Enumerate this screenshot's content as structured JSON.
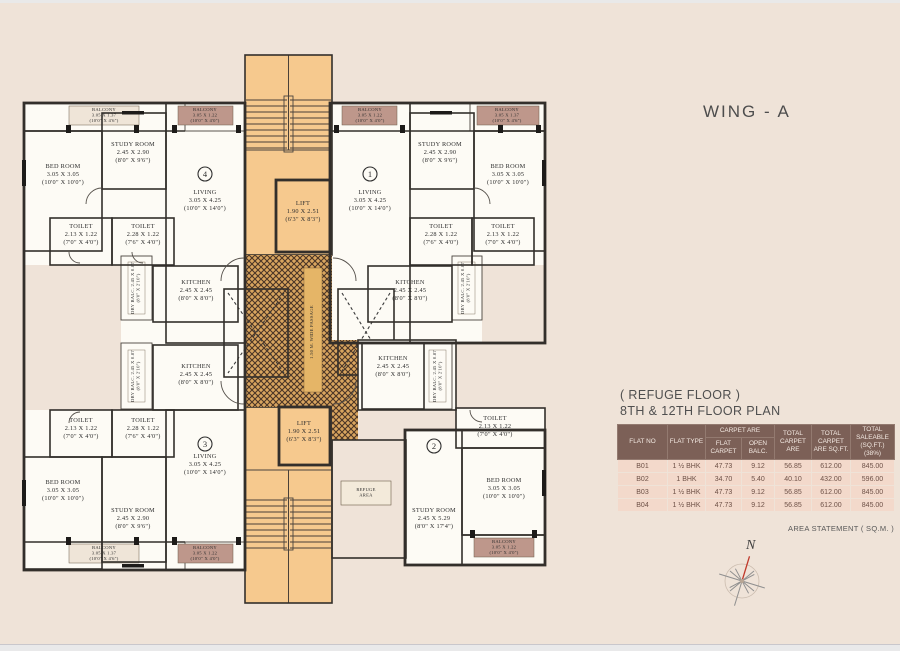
{
  "window": {
    "wing_title": "WING - A"
  },
  "plan_header": {
    "line1": "( REFUGE FLOOR )",
    "line2": "8TH & 12TH FLOOR PLAN"
  },
  "table": {
    "headers": {
      "flat_no": "FLAT NO",
      "flat_type": "FLAT TYPE",
      "carpet_group": "CARPET ARE",
      "flat_carpet": "FLAT CARPET",
      "open_balc": "OPEN BALC.",
      "total_carpet": "TOTAL CARPET ARE",
      "total_carpet_sqft": "TOTAL CARPET ARE SQ.FT.",
      "total_saleable": "TOTAL SALEABLE (SQ.FT.) (38%)"
    },
    "rows": [
      [
        "B01",
        "1 ½ BHK",
        "47.73",
        "9.12",
        "56.85",
        "612.00",
        "845.00"
      ],
      [
        "B02",
        "1 BHK",
        "34.70",
        "5.40",
        "40.10",
        "432.00",
        "596.00"
      ],
      [
        "B03",
        "1 ½ BHK",
        "47.73",
        "9.12",
        "56.85",
        "612.00",
        "845.00"
      ],
      [
        "B04",
        "1 ½ BHK",
        "47.73",
        "9.12",
        "56.85",
        "612.00",
        "845.00"
      ]
    ],
    "footer": "AREA STATEMENT ( SQ.M. )"
  },
  "compass": {
    "label": "N"
  },
  "colors": {
    "page_bg": "#efe3d8",
    "table_header_bg": "#7c6057",
    "table_row_bg": "#f3d9cb",
    "stair_fill": "#f6c98e",
    "passage_gold": "#d9a55f",
    "balcony_brown": "#b3887c",
    "room_fill": "#fdfbf5",
    "wall": "#332f2b",
    "compass_needle": "#c0392b"
  },
  "floorplan": {
    "rooms": [
      {
        "name": "BED ROOM",
        "dim": "3.05 X 3.05",
        "ft": "(10'0\" X 10'0\")",
        "x": 63,
        "y": 168
      },
      {
        "name": "STUDY ROOM",
        "dim": "2.45 X 2.90",
        "ft": "(8'0\" X 9'6\")",
        "x": 133,
        "y": 146
      },
      {
        "name": "LIVING",
        "dim": "3.05 X 4.25",
        "ft": "(10'0\" X 14'0\")",
        "x": 205,
        "y": 194
      },
      {
        "name": "TOILET",
        "dim": "2.13 X 1.22",
        "ft": "(7'0\" X 4'0\")",
        "x": 81,
        "y": 228
      },
      {
        "name": "TOILET",
        "dim": "2.28 X 1.22",
        "ft": "(7'6\" X 4'0\")",
        "x": 143,
        "y": 228
      },
      {
        "name": "KITCHEN",
        "dim": "2.45 X 2.45",
        "ft": "(8'0\" X 8'0\")",
        "x": 196,
        "y": 284
      },
      {
        "name": "BALCONY",
        "dim": "3.05 X 1.37",
        "ft": "(10'0\" X 4'6\")",
        "x": 104,
        "y": 111,
        "small": true
      },
      {
        "name": "BALCONY",
        "dim": "3.05 X 1.22",
        "ft": "(10'0\" X 4'0\")",
        "x": 205,
        "y": 111,
        "small": true
      },
      {
        "name": "DRY BALC. 2.45 X 0.87",
        "dim": "(8'0\" X 2'10\")",
        "x": 134,
        "y": 288,
        "vert": true,
        "small": true
      },
      {
        "name": "LIVING",
        "dim": "3.05 X 4.25",
        "ft": "(10'0\" X 14'0\")",
        "x": 370,
        "y": 194
      },
      {
        "name": "STUDY ROOM",
        "dim": "2.45 X 2.90",
        "ft": "(8'0\" X 9'6\")",
        "x": 440,
        "y": 146
      },
      {
        "name": "BED ROOM",
        "dim": "3.05 X 3.05",
        "ft": "(10'0\" X 10'0\")",
        "x": 508,
        "y": 168
      },
      {
        "name": "TOILET",
        "dim": "2.28 X 1.22",
        "ft": "(7'6\" X 4'0\")",
        "x": 441,
        "y": 228
      },
      {
        "name": "TOILET",
        "dim": "2.13 X 1.22",
        "ft": "(7'0\" X 4'0\")",
        "x": 503,
        "y": 228
      },
      {
        "name": "KITCHEN",
        "dim": "2.45 X 2.45",
        "ft": "(8'0\" X 8'0\")",
        "x": 410,
        "y": 284
      },
      {
        "name": "BALCONY",
        "dim": "3.05 X 1.22",
        "ft": "(10'0\" X 4'0\")",
        "x": 370,
        "y": 111,
        "small": true
      },
      {
        "name": "BALCONY",
        "dim": "3.05 X 1.37",
        "ft": "(10'0\" X 4'6\")",
        "x": 507,
        "y": 111,
        "small": true
      },
      {
        "name": "DRY BALC. 2.45 X 0.87",
        "dim": "(8'0\" X 2'10\")",
        "x": 464,
        "y": 288,
        "vert": true,
        "small": true
      },
      {
        "name": "KITCHEN",
        "dim": "2.45 X 2.45",
        "ft": "(8'0\" X 8'0\")",
        "x": 196,
        "y": 368
      },
      {
        "name": "DRY BALC. 2.45 X 0.87",
        "dim": "(8'0\" X 2'10\")",
        "x": 134,
        "y": 376,
        "vert": true,
        "small": true
      },
      {
        "name": "TOILET",
        "dim": "2.13 X 1.22",
        "ft": "(7'0\" X 4'0\")",
        "x": 81,
        "y": 422
      },
      {
        "name": "TOILET",
        "dim": "2.28 X 1.22",
        "ft": "(7'6\" X 4'0\")",
        "x": 143,
        "y": 422
      },
      {
        "name": "BED ROOM",
        "dim": "3.05 X 3.05",
        "ft": "(10'0\" X 10'0\")",
        "x": 63,
        "y": 484
      },
      {
        "name": "STUDY ROOM",
        "dim": "2.45 X 2.90",
        "ft": "(8'0\" X 9'6\")",
        "x": 133,
        "y": 512
      },
      {
        "name": "LIVING",
        "dim": "3.05 X 4.25",
        "ft": "(10'0\" X 14'0\")",
        "x": 205,
        "y": 458
      },
      {
        "name": "BALCONY",
        "dim": "3.05 X 1.37",
        "ft": "(10'0\" X 4'6\")",
        "x": 104,
        "y": 549,
        "small": true
      },
      {
        "name": "BALCONY",
        "dim": "3.05 X 1.22",
        "ft": "(10'0\" X 4'0\")",
        "x": 205,
        "y": 549,
        "small": true
      },
      {
        "name": "KITCHEN",
        "dim": "2.45 X 2.45",
        "ft": "(8'0\" X 8'0\")",
        "x": 393,
        "y": 360
      },
      {
        "name": "DRY BALC. 2.45 X 0.87",
        "dim": "(8'0\" X 2'10\")",
        "x": 436,
        "y": 376,
        "vert": true,
        "small": true
      },
      {
        "name": "TOILET",
        "dim": "2.13 X 1.22",
        "ft": "(7'0\" X 4'0\")",
        "x": 495,
        "y": 420
      },
      {
        "name": "BED ROOM",
        "dim": "3.05 X 3.05",
        "ft": "(10'0\" X 10'0\")",
        "x": 504,
        "y": 482
      },
      {
        "name": "STUDY ROOM",
        "dim": "2.45 X 5.29",
        "ft": "(8'0\" X 17'4\")",
        "x": 434,
        "y": 512
      },
      {
        "name": "BALCONY",
        "dim": "3.05 X 1.22",
        "ft": "(10'0\" X 4'0\")",
        "x": 504,
        "y": 543,
        "small": true
      },
      {
        "name": "REFUGE",
        "dim": "AREA",
        "x": 366,
        "y": 491,
        "small": true
      },
      {
        "name": "LIFT",
        "dim": "1.90 X 2.51",
        "ft": "(6'3\" X 8'3\")",
        "x": 303,
        "y": 205
      },
      {
        "name": "LIFT",
        "dim": "1.90 X 2.51",
        "ft": "(6'3\" X 8'3\")",
        "x": 304,
        "y": 425
      },
      {
        "name": "1.50 M. WIDE PASSAGE",
        "x": 313,
        "y": 332,
        "vert": true,
        "small": true
      }
    ],
    "flat_markers": [
      {
        "n": "4",
        "x": 205,
        "y": 174
      },
      {
        "n": "1",
        "x": 370,
        "y": 174
      },
      {
        "n": "3",
        "x": 205,
        "y": 444
      },
      {
        "n": "2",
        "x": 434,
        "y": 446
      }
    ]
  }
}
